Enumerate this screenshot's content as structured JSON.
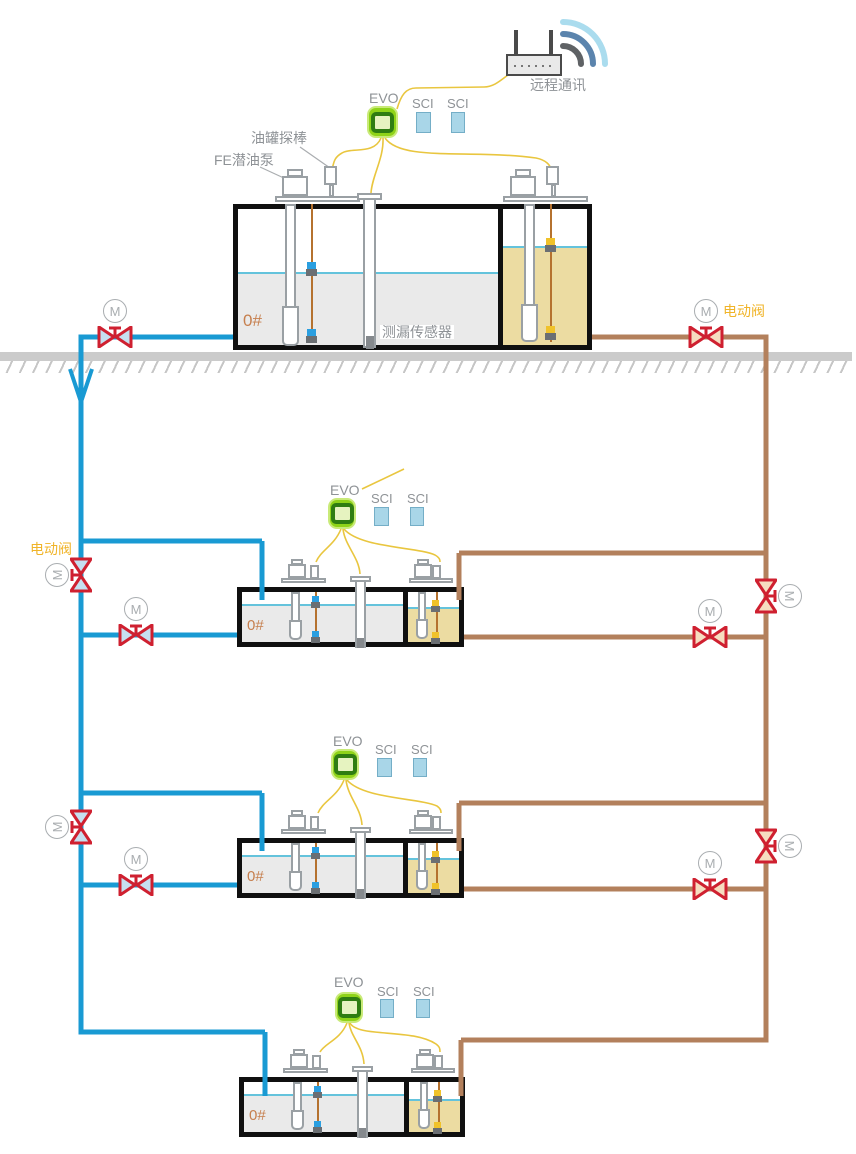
{
  "labels": {
    "remote_comm": "远程通讯",
    "evo": "EVO",
    "sci": "SCI",
    "tank_probe": "油罐探棒",
    "submersible_pump": "FE潜油泵",
    "leak_sensor": "测漏传感器",
    "electric_valve": "电动阀",
    "motor": "M",
    "fuel_grade": "0#"
  },
  "tanks": [
    {
      "name": "surface-tank",
      "grade": "0#"
    },
    {
      "name": "buried-tank-1",
      "grade": "0#"
    },
    {
      "name": "buried-tank-2",
      "grade": "0#"
    },
    {
      "name": "buried-tank-3",
      "grade": "0#"
    }
  ],
  "colors": {
    "pipe-blue": "#199ad3",
    "pipe-brown": "#b3805c",
    "valve-red": "#cf2030",
    "valve-fill-blue": "#c6dff0",
    "valve-fill-tan": "#f6ddc0",
    "valve-label-orange": "#f0b429",
    "evo-green": "#8fd319",
    "evo-ring": "#2f7d12",
    "sci-blue": "#a9d6e8",
    "wire-yellow": "#e9c63f",
    "liquid-gray": "#eaeaea",
    "diesel-yellow": "#ecdca2",
    "water-line": "#64c3dc",
    "float-yellow": "#f0c22a",
    "label-gray": "#8e9296",
    "grade-orange": "#c67f4e",
    "ground-gray": "#cbcbcb"
  }
}
